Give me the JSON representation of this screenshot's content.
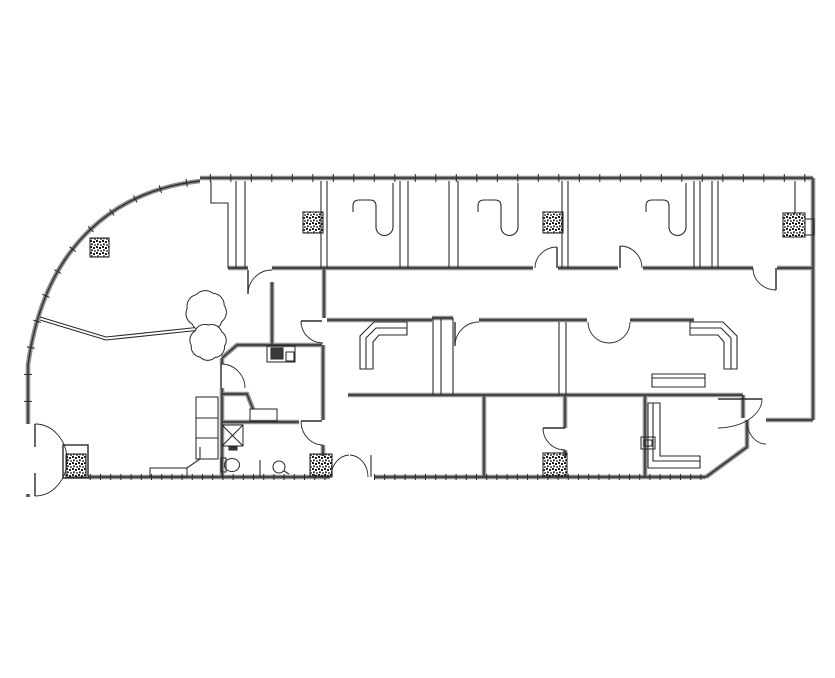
{
  "document": {
    "background": "#ffffff",
    "width": 835,
    "height": 678
  },
  "colors": {
    "wall_gray": "#8f8f8f",
    "wall_core": "#2f2f2f",
    "thin_line": "#2a2a2a",
    "hatch_dot": "#1d1d1d",
    "fixture_fill": "#3a3a3a"
  },
  "walls_thick": [
    {
      "d": "M200,178 L813,178",
      "ticks": 20.5,
      "tlen": 8
    },
    {
      "d": "M813,178 L813,420"
    },
    {
      "d": "M813,420 L766,420"
    },
    {
      "d": "M747,420 L747,447 L706,477"
    },
    {
      "d": "M706,477 L374,477",
      "ticks": 10.2,
      "tlen": 6
    },
    {
      "d": "M330,477 L88,477",
      "ticks": 10.2,
      "tlen": 6
    },
    {
      "d": "M200,181 C120,190 45,240 28,365 L28,424",
      "ticks": 27,
      "tlen": 8
    },
    {
      "d": "M28,494 L28,497"
    },
    {
      "d": "M228,268 L248,268"
    },
    {
      "d": "M272,268 L533,268"
    },
    {
      "d": "M558,268 L618,268"
    },
    {
      "d": "M643,268 L753,268"
    },
    {
      "d": "M777,268 L813,268"
    },
    {
      "d": "M327,320 L432,320"
    },
    {
      "d": "M479,320 L587,320"
    },
    {
      "d": "M630,320 L694,320"
    },
    {
      "d": "M222,358 L237,345 L322,345"
    },
    {
      "d": "M222,358 L222,364"
    },
    {
      "d": "M222,388 L222,477"
    },
    {
      "d": "M348,395 L743,395"
    },
    {
      "d": "M484,395 L484,477"
    },
    {
      "d": "M565,395 L565,428"
    },
    {
      "d": "M565,450 L565,456"
    },
    {
      "d": "M645,395 L645,477"
    },
    {
      "d": "M324,268 L324,318"
    },
    {
      "d": "M272,282 L272,345"
    },
    {
      "d": "M323,345 L323,420"
    },
    {
      "d": "M323,445 L323,456"
    },
    {
      "d": "M222,422 L299,422"
    },
    {
      "d": "M222,394 L247,394 L253,409"
    },
    {
      "d": "M743,395 L743,418"
    },
    {
      "d": "M432,318 L453,318"
    }
  ],
  "walls_thin": [
    "M236,181 L236,268",
    "M245,181 L245,268",
    "M236,268 L245,268",
    "M321,181 L321,268",
    "M327,181 L327,268",
    "M400,181 L400,268",
    "M408,181 L408,268",
    "M449,181 L449,268",
    "M458,181 L458,268",
    "M562,181 L562,268",
    "M568,181 L568,268",
    "M694,181 L694,268",
    "M700,181 L700,268",
    "M712,181 L712,268",
    "M718,181 L718,268",
    "M795,181 L795,213",
    "M211,181 L211,203 L228,203 L228,268",
    "M559,322 L559,395",
    "M566,322 L566,395",
    "M433,318 L433,395",
    "M441,318 L441,395",
    "M453,318 L453,395",
    "M40,317 L106,337 L201,327",
    "M40,320 L106,340 L201,330",
    "M260,460 L260,477",
    "M371,455 L371,477"
  ],
  "doors": [
    {
      "leaf": "M35,424 L35,447",
      "arc": "M35,424 A32,36 0 0 1 67,460"
    },
    {
      "leaf": "M35,473 L35,496",
      "arc": "M35,496 A32,36 0 0 0 67,460"
    },
    {
      "leaf": "M248,270 L248,294",
      "arc": "M248,294 A24,24 0 0 1 272,270"
    },
    {
      "leaf": "M557,247 L557,268",
      "arc": "M557,247 A22,21 0 0 0 535,268"
    },
    {
      "leaf": "M620,246 L620,268",
      "arc": "M620,246 A22,22 0 0 1 642,268"
    },
    {
      "leaf": "M776,268 L776,290",
      "arc": "M753,268 A23,22 0 0 0 776,290"
    },
    {
      "leaf": "M455,322 L455,346",
      "arc": "M455,346 A24,24 0 0 1 479,322"
    },
    {
      "leaf": "",
      "arc": "M588,322 A21,21 0 0 0 609,343"
    },
    {
      "leaf": "",
      "arc": "M630,322 A21,21 0 0 1 609,343"
    },
    {
      "leaf": "M221,364 L221,388",
      "arc": "M221,364 A24,24 0 0 1 245,388"
    },
    {
      "leaf": "M301,421 L322,421",
      "arc": "M301,421 A22,24 0 0 0 323,445"
    },
    {
      "leaf": "M301,321 L322,321",
      "arc": "M301,321 A22,22 0 0 0 323,343"
    },
    {
      "leaf": "M543,428 L565,428",
      "arc": "M543,428 A22,22 0 0 0 565,450"
    },
    {
      "leaf": "",
      "arc": "M331,477 A19,22 0 0 1 349,455"
    },
    {
      "leaf": "",
      "arc": "M368,477 A19,22 0 0 0 350,455"
    },
    {
      "leaf": "M718,399 L762,399",
      "arc": "M762,399 A45,29 0 0 1 718,428"
    },
    {
      "leaf": "",
      "arc": "M747,421 A19,23 0 0 0 766,444"
    }
  ],
  "columns": [
    {
      "x": 90,
      "y": 238,
      "w": 19,
      "h": 19
    },
    {
      "x": 303,
      "y": 212,
      "w": 20,
      "h": 21
    },
    {
      "x": 543,
      "y": 212,
      "w": 20,
      "h": 21
    },
    {
      "x": 783,
      "y": 213,
      "w": 22,
      "h": 24
    },
    {
      "x": 66,
      "y": 454,
      "w": 20,
      "h": 23,
      "frame": {
        "x": 63,
        "y": 445,
        "w": 25,
        "h": 33
      }
    },
    {
      "x": 310,
      "y": 454,
      "w": 22,
      "h": 23
    },
    {
      "x": 543,
      "y": 453,
      "w": 24,
      "h": 24
    }
  ],
  "furniture_paths": [
    "M393,183 L393,227 A8.5,8.5 0 0 1 376,227 L376,206 Q376,200 370,200 L359,200 Q353,200 353,206 L353,212",
    "M478,212 L478,206 Q478,200 484,200 L495,200 Q501,200 501,206 L501,227 A8.5,8.5 0 0 0 518,227 L518,183",
    "M646,212 L646,206 Q646,200 652,200 L663,200 Q669,200 669,206 L669,227 A8.5,8.5 0 0 0 686,227 L686,183",
    "M407,322 L374,322 L360,336 L360,369 L373,369 L373,342 L379,335 L407,335 Z",
    "M407,328 L376,328 L366,338 L366,369",
    "M690,322 L723,322 L737,336 L737,369 L724,369 L724,342 L718,335 L690,335 Z",
    "M690,328 L721,328 L731,338 L731,369",
    "M648,403 L660,403 L660,456 L700,456 L700,468 L648,468 Z",
    "M653,403 L653,461 L700,461",
    "M652,374 L705,374 L705,387 L652,387 Z",
    "M652,378 L705,378",
    "M196,418 L218,418",
    "M196,438 L218,438",
    "M187,468 L200,459 L200,447",
    "M222,425 L243,446",
    "M243,425 L222,446",
    "M284,471 L289,474"
  ],
  "fixture_rects": [
    {
      "x": 196,
      "y": 397,
      "w": 22,
      "h": 62
    },
    {
      "x": 150,
      "y": 468,
      "w": 37,
      "h": 9
    },
    {
      "x": 250,
      "y": 409,
      "w": 27,
      "h": 12
    },
    {
      "x": 222,
      "y": 425,
      "w": 21,
      "h": 21
    },
    {
      "x": 229,
      "y": 447,
      "w": 8,
      "h": 3,
      "fill": true
    },
    {
      "x": 267,
      "y": 346,
      "w": 28,
      "h": 16
    },
    {
      "x": 271,
      "y": 348,
      "w": 12,
      "h": 11,
      "fill": true
    },
    {
      "x": 286,
      "y": 352,
      "w": 8,
      "h": 9
    },
    {
      "x": 641,
      "y": 437,
      "w": 14,
      "h": 12
    },
    {
      "x": 644,
      "y": 440,
      "w": 8,
      "h": 6
    },
    {
      "x": 805,
      "y": 219,
      "w": 9,
      "h": 16
    },
    {
      "x": 221,
      "y": 458,
      "w": 5,
      "h": 14
    }
  ],
  "fixture_circles": [
    {
      "cx": 279,
      "cy": 467,
      "r": 6
    }
  ],
  "fixture_ellipses": [
    {
      "cx": 232,
      "cy": 465,
      "rx": 7.5,
      "ry": 6.5
    }
  ],
  "plants": [
    {
      "cx": 206,
      "cy": 311,
      "r": 19,
      "petals": 7,
      "rot": -0.3
    },
    {
      "cx": 208,
      "cy": 342,
      "r": 17,
      "petals": 7,
      "rot": 0.25
    }
  ]
}
